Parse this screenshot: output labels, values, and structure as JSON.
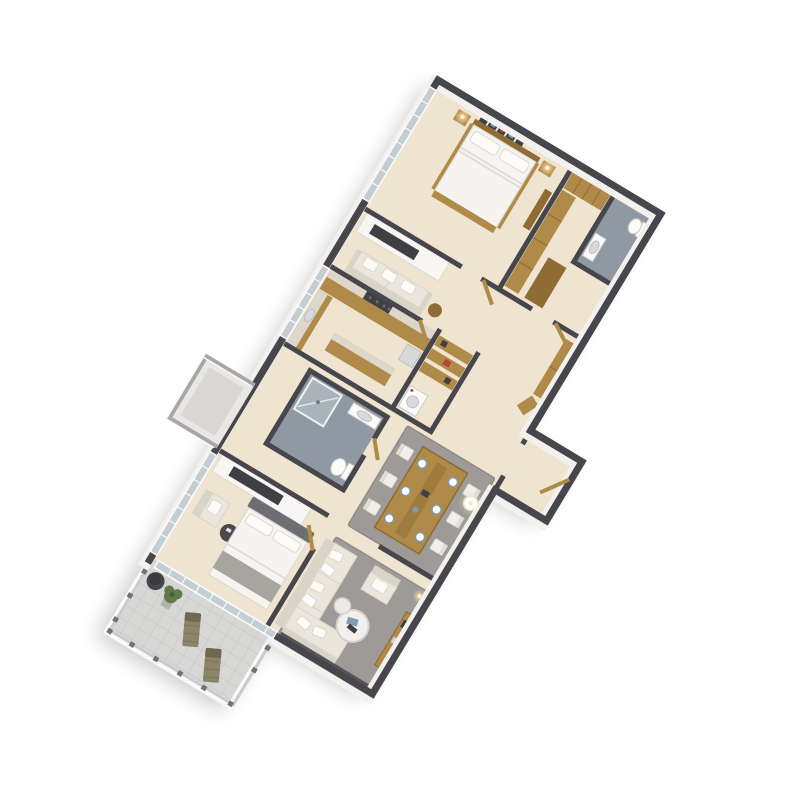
{
  "scene": {
    "description": "3D isometric architectural render of a multi-room apartment floor plan, rotated diagonally on a white background, with a furnished balcony at the lower left",
    "rotation_deg": 31,
    "background": "#ffffff",
    "rooms": [
      {
        "name": "Master Bedroom",
        "furniture": [
          "double bed with white duvet",
          "wood bed frame and headboard",
          "two nightstands",
          "two lit lamps",
          "gallery wall of framed pictures",
          "tall dresser",
          "floor-to-ceiling windows"
        ]
      },
      {
        "name": "Walk-in Closet",
        "furniture": [
          "L-shaped wood wardrobe units",
          "open shelving"
        ]
      },
      {
        "name": "Ensuite Bathroom",
        "furniture": [
          "toilet",
          "vanity sink",
          "gray tile floor"
        ]
      },
      {
        "name": "TV Lounge",
        "furniture": [
          "media wall with dark TV niche",
          "cream loveseat with pillows",
          "round side table"
        ]
      },
      {
        "name": "Kitchen",
        "furniture": [
          "wood cabinets",
          "marble countertops",
          "dark cooktop with burners",
          "sink",
          "island counter",
          "refrigerator"
        ]
      },
      {
        "name": "Pantry / Laundry",
        "furniture": [
          "wood shelving",
          "washer",
          "red storage boxes"
        ]
      },
      {
        "name": "Bathroom 2",
        "furniture": [
          "glass shower with gray tile",
          "vanity sink",
          "toilet"
        ]
      },
      {
        "name": "Hallway",
        "furniture": [
          "wood wardrobe",
          "wood doors ajar"
        ]
      },
      {
        "name": "Dining Area",
        "furniture": [
          "rectangular wood dining table",
          "six white chairs",
          "blue-and-white place settings",
          "gray rug",
          "glowing ceiling light"
        ]
      },
      {
        "name": "Entry Foyer",
        "furniture": [
          "wood entry door in side protrusion"
        ]
      },
      {
        "name": "Bedroom 2",
        "furniture": [
          "double bed with white duvet",
          "gray upholstered headboard",
          "gray throw blanket",
          "cream armchair",
          "two round side tables",
          "media wall with dark TV niche",
          "windows"
        ]
      },
      {
        "name": "Living Room",
        "furniture": [
          "L-shaped cream sectional sofa with throw pillows",
          "cream armchair",
          "two round nesting coffee tables with books",
          "gray rug",
          "wood sideboard",
          "dark feature wall",
          "glowing wall sconce"
        ]
      },
      {
        "name": "Balcony",
        "furniture": [
          "metal railing with posts",
          "gray paver tile floor",
          "two olive sun loungers",
          "potted green plant",
          "round dark planter"
        ]
      },
      {
        "name": "Service Ledge",
        "furniture": [
          "white framed planter box protruding from left facade"
        ]
      }
    ]
  },
  "palette": {
    "wallCap": "#46464c",
    "wallFace": "#f3f1ee",
    "darkWall": "#54545a",
    "floor": "#efe4d0",
    "wood": "#b08a48",
    "woodDark": "#8f6c33",
    "marble": "#ddd7cc",
    "dark": "#3f3f44",
    "tile": "#8f99a3",
    "tileLight": "#aab3bb",
    "glass": "#c3cdd2",
    "frame": "#fafafa",
    "rug": "#9d9a97",
    "rugDark": "#8f8c89",
    "sofa": "#eae6dc",
    "sofaShade": "#d9d4c8",
    "bedding": "#f6f4f0",
    "beddingEdge": "#ddd9d0",
    "headboard": "#6e6e72",
    "throw": "#a8a5a0",
    "olive": "#8c8468",
    "oliveDark": "#6f6750",
    "railing": "#c7cbcd",
    "post": "#6d7275",
    "paver": "#d7d7d5",
    "paverLine": "#c3c3c1",
    "plant": "#5d7a4a",
    "pot": "#b3b0aa",
    "silver": "#d8d9da",
    "red": "#b5452f",
    "blue": "#7d9bb5",
    "shadow": "#8a8884",
    "glowWarm": "#ffd9a0",
    "glowCore": "#fff3d8"
  }
}
